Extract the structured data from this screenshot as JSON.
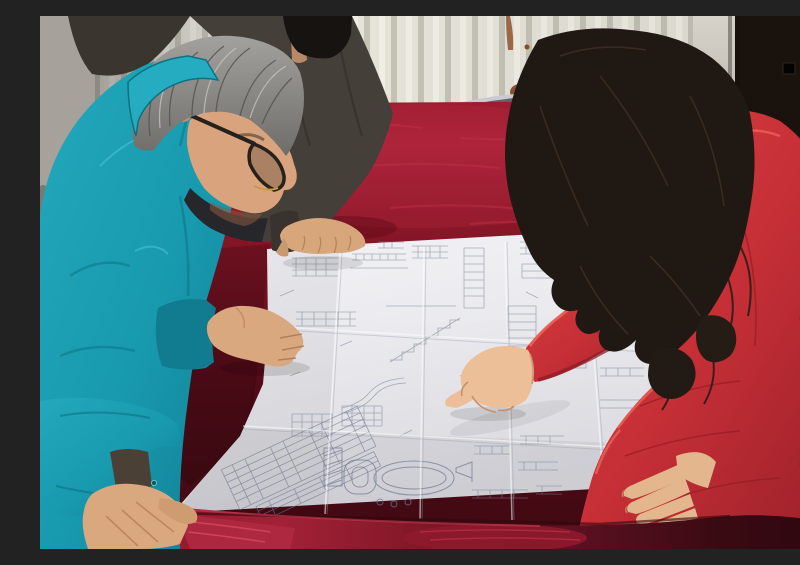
{
  "meta": {
    "type": "photograph",
    "description": "Three people lean over a large folded engineering blueprint spread on a dark red velvet covered table, in a room with a white column radiator and a dark door panel.",
    "caption": "Workers reviewing a technical drawing on a velvet-covered table"
  },
  "people": [
    {
      "id": "engineer-left",
      "description": "Middle-aged man with gray hair and dark-rimmed glasses in a teal work jacket, leaning over the drawing, right hand on the sheet and left hand gripping the table corner"
    },
    {
      "id": "colleague-behind",
      "description": "Partially hidden colleague in a dark gray-brown jacket with black hair, right hand resting on the top edge of the drawing"
    },
    {
      "id": "woman-right",
      "description": "Woman with long dark wavy hair in a red padded parka with an orange fur-trimmed hood, pointing at the drawing with her right index finger, left fingers resting on the sheet edge"
    }
  ],
  "objects": {
    "blueprint": {
      "description": "Large white multi-fold technical drawing with stair sections, dimension ladders, small data tables, an oval tank detail and a rotated title block",
      "folds": "4 x 3 crease grid"
    },
    "table": {
      "description": "Large table draped in dark red crushed velvet, bright crimson where the light hits the far surface and front edge"
    },
    "radiator": {
      "description": "White vertical-fin wall radiator with rust stains"
    },
    "chair": {
      "description": "Chrome tube framed chair with red seat visible behind the table"
    },
    "door": {
      "description": "Very dark door panel on the right with a small black fitting, light painted frame strip beside it"
    },
    "wall": {
      "description": "Gray plaster wall strip at the far left with a dark stain"
    }
  },
  "palette": {
    "wall_gray": "#a6a29b",
    "radiator_white": "#e7e4da",
    "door_dark": "#15100c",
    "frame_strip": "#cfcbc2",
    "velvet_bright": "#a92138",
    "velvet_dark": "#3f0912",
    "paper": "#ececf0",
    "drawing_line": "#7b8498",
    "teal_jacket": "#1899ae",
    "dark_jacket": "#443f39",
    "red_coat": "#c62f36",
    "fur_trim": "#b4731f",
    "hair_black": "#1f1813",
    "hair_gray": "#8f8d89",
    "skin": "#d9a87e",
    "chrome": "#c7ccd0"
  }
}
